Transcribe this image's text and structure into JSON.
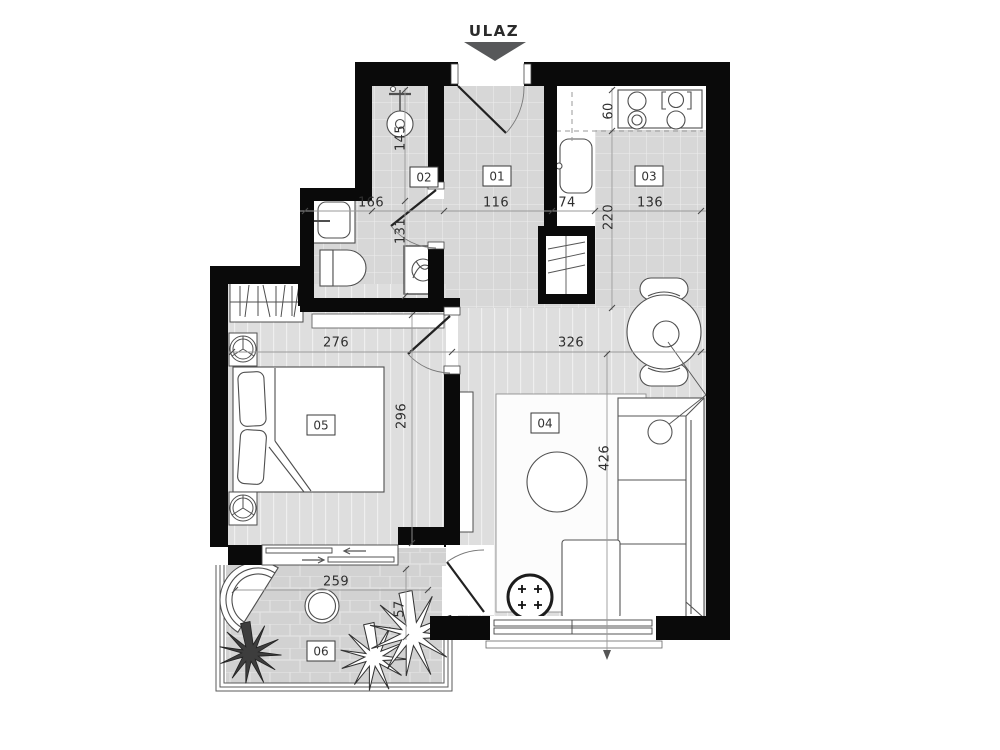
{
  "entrance": {
    "label": "ULAZ"
  },
  "rooms": [
    {
      "number": "01",
      "name": "hallway"
    },
    {
      "number": "02",
      "name": "bathroom"
    },
    {
      "number": "03",
      "name": "kitchen"
    },
    {
      "number": "04",
      "name": "living-room"
    },
    {
      "number": "05",
      "name": "bedroom"
    },
    {
      "number": "06",
      "name": "balcony"
    }
  ],
  "dimensions": {
    "bath_upper_len": "145",
    "bath_width": "166",
    "bath_lower_len": "131",
    "hall_width": "116",
    "counter_width": "74",
    "counter_depth": "60",
    "kitchen_len": "220",
    "kitchen_width": "136",
    "bedroom_width": "276",
    "living_width": "326",
    "bedroom_len": "296",
    "living_len": "426",
    "balcony_width": "259",
    "balcony_depth": "57"
  },
  "colors": {
    "wall": "#0a0a0a",
    "floor_tile": "#d7d7d7",
    "floor_plank": "#dedede",
    "floor_paver": "#d2d2d2",
    "entrance_arrow": "#57585a",
    "furniture_stroke": "#4f4f4f"
  }
}
